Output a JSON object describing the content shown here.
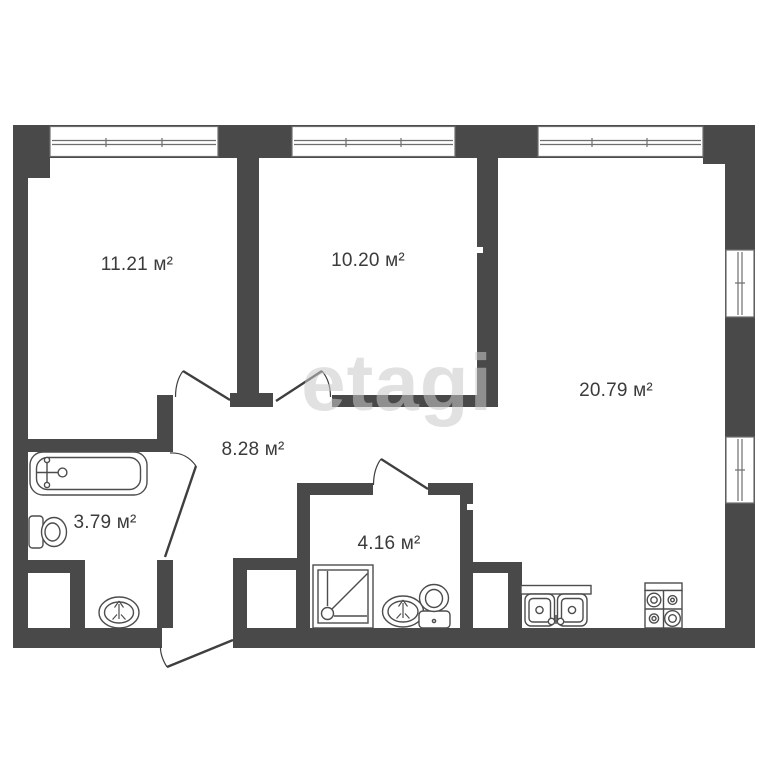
{
  "plan": {
    "type": "apartment-floor-plan",
    "watermark": {
      "text": "etagi"
    },
    "rooms": [
      {
        "id": "room-top-left",
        "area_label": "11.21 м²"
      },
      {
        "id": "room-top-middle",
        "area_label": "10.20 м²"
      },
      {
        "id": "room-right",
        "area_label": "20.79 м²"
      },
      {
        "id": "hallway",
        "area_label": "8.28 м²"
      },
      {
        "id": "bathroom",
        "area_label": "3.79 м²"
      },
      {
        "id": "shower-room",
        "area_label": "4.16 м²"
      }
    ],
    "fixtures": [
      "bathtub",
      "toilet",
      "sink",
      "shower-tray",
      "kitchen-double-sink",
      "stove-4-burners",
      "ventilation-shaft"
    ],
    "openings": {
      "windows_top": 3,
      "windows_right": 2,
      "interior_doors": 4,
      "entrance_doors": 1,
      "open-passages": 1
    }
  },
  "colors": {
    "wall": "#494949",
    "window_stroke": "#6e6e6e",
    "fixture_stroke": "#4d4d4d",
    "door_stroke": "#3f3f3f",
    "label_text": "#3b3b3b",
    "watermark": "#c8c8c8",
    "background": "#ffffff"
  }
}
